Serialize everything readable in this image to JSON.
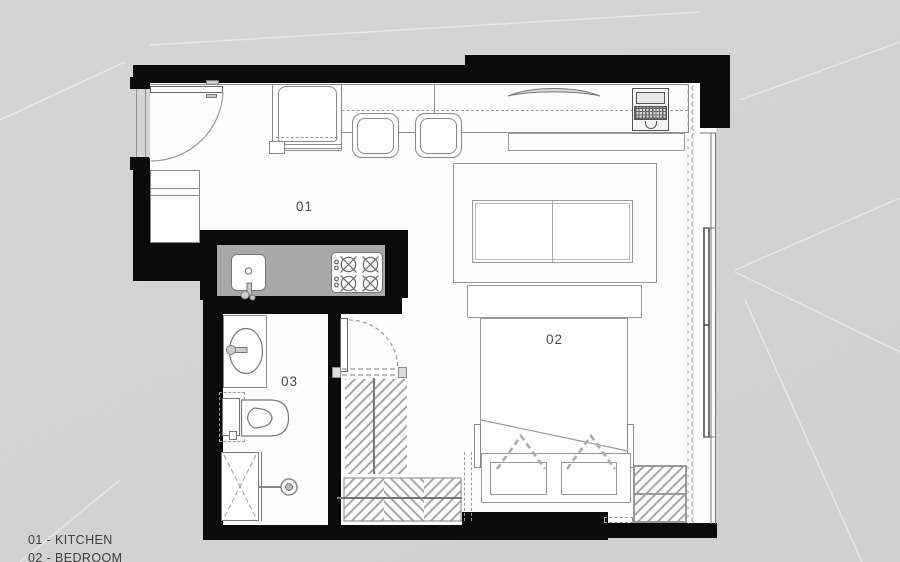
{
  "legend": {
    "items": [
      {
        "text": "01 - KITCHEN"
      },
      {
        "text": "02 - BEDROOM"
      }
    ]
  },
  "room_labels": {
    "kitchen": "01",
    "bedroom": "02",
    "bathroom": "03"
  },
  "colors": {
    "wall": "#0b0b0b",
    "counter": "#a8a8a8",
    "exterior_background": "#d2d2d2",
    "interior_floor": "#fdfdfd",
    "drawing_line": "#8f8f8f"
  }
}
